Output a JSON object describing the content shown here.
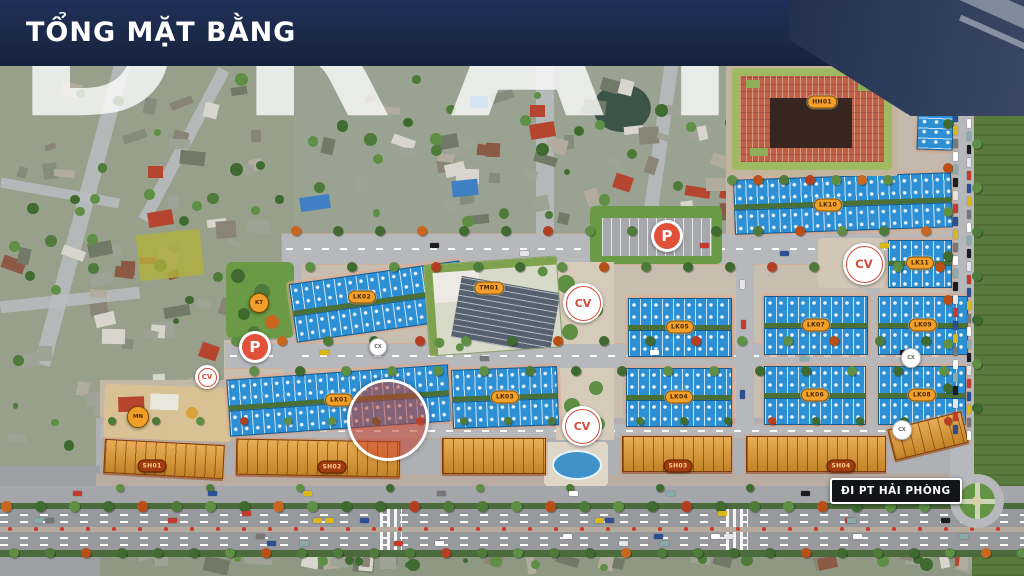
{
  "banner": {
    "title": "TỔNG MẶT BẰNG"
  },
  "watermark": {
    "text": "DRAFT"
  },
  "road_sign": {
    "text": "ĐI PT HẢI PHÒNG"
  },
  "palette": {
    "banner_bg": "#1b2846",
    "townhouse_roof": "#2d8fd4",
    "shophouse_roof": "#e59a2f",
    "label_bg": "#f1a02b",
    "marker_red": "#d14b38",
    "park_green": "#6a9a45",
    "road_grey": "#b6b8bb"
  },
  "blocks": [
    {
      "label": "LK01",
      "x": 228,
      "y": 372,
      "w": 222,
      "h": 56,
      "rot": -4
    },
    {
      "label": "LK02",
      "x": 292,
      "y": 272,
      "w": 172,
      "h": 58,
      "rot": -8,
      "lx": 362,
      "ly": 297
    },
    {
      "label": "LK03",
      "x": 452,
      "y": 368,
      "w": 106,
      "h": 58,
      "rot": -2
    },
    {
      "label": "LK04",
      "x": 626,
      "y": 368,
      "w": 106,
      "h": 58,
      "rot": 0
    },
    {
      "label": "LK05",
      "x": 628,
      "y": 298,
      "w": 104,
      "h": 58,
      "rot": 0
    },
    {
      "label": "LK06",
      "x": 764,
      "y": 366,
      "w": 102,
      "h": 58,
      "rot": 0
    },
    {
      "label": "LK07",
      "x": 764,
      "y": 296,
      "w": 104,
      "h": 58,
      "rot": 0
    },
    {
      "label": "LK08",
      "x": 878,
      "y": 366,
      "w": 88,
      "h": 58,
      "rot": 0
    },
    {
      "label": "LK09",
      "x": 878,
      "y": 296,
      "w": 90,
      "h": 58,
      "rot": 0
    },
    {
      "label": "LK10",
      "x": 734,
      "y": 176,
      "w": 218,
      "h": 54,
      "rot": -2,
      "lx": 828,
      "ly": 205
    },
    {
      "label": "LK11",
      "x": 888,
      "y": 240,
      "w": 64,
      "h": 46,
      "rot": 0
    },
    {
      "label": "LK12",
      "x": 918,
      "y": 66,
      "w": 36,
      "h": 84,
      "rot": 2,
      "vertical": true,
      "lx": 946,
      "ly": 95
    }
  ],
  "shop_rows": [
    {
      "label": "SH01",
      "x": 104,
      "y": 442,
      "w": 118,
      "h": 32,
      "rot": 3,
      "lx": 152,
      "ly": 466
    },
    {
      "label": "SH02",
      "x": 236,
      "y": 440,
      "w": 162,
      "h": 34,
      "rot": 1,
      "lx": 332,
      "ly": 467
    },
    {
      "label": "",
      "x": 442,
      "y": 438,
      "w": 102,
      "h": 34,
      "rot": 0
    },
    {
      "label": "SH03",
      "x": 622,
      "y": 436,
      "w": 108,
      "h": 34,
      "rot": 0,
      "lx": 678,
      "ly": 466
    },
    {
      "label": "SH04",
      "x": 746,
      "y": 436,
      "w": 138,
      "h": 34,
      "rot": 0,
      "lx": 841,
      "ly": 466
    },
    {
      "label": "",
      "x": 890,
      "y": 420,
      "w": 74,
      "h": 30,
      "rot": -14
    }
  ],
  "special": [
    {
      "label": "TM01",
      "type": "commercial-center",
      "x": 426,
      "y": 260,
      "w": 132,
      "h": 90,
      "rot": -4,
      "lx": 489,
      "ly": 288
    },
    {
      "label": "HH01",
      "type": "mixed-use-tower",
      "x": 726,
      "y": 62,
      "w": 172,
      "h": 114,
      "rot": 0,
      "lx": 822,
      "ly": 102
    }
  ],
  "markers": [
    {
      "text": "P",
      "type": "parking",
      "x": 255,
      "y": 347,
      "r": 16
    },
    {
      "text": "P",
      "type": "parking",
      "x": 667,
      "y": 236,
      "r": 16
    },
    {
      "text": "CV",
      "type": "park",
      "x": 207,
      "y": 377,
      "r": 12
    },
    {
      "text": "CV",
      "type": "park",
      "x": 583,
      "y": 303,
      "r": 20
    },
    {
      "text": "CV",
      "type": "park",
      "x": 582,
      "y": 426,
      "r": 20
    },
    {
      "text": "CV",
      "type": "park",
      "x": 864,
      "y": 264,
      "r": 21
    },
    {
      "text": "KT",
      "type": "technical",
      "x": 258,
      "y": 302,
      "r": 9
    },
    {
      "text": "MN",
      "type": "kindergarten",
      "x": 137,
      "y": 416,
      "r": 10
    },
    {
      "text": "CX",
      "type": "green",
      "x": 377,
      "y": 346,
      "r": 8
    },
    {
      "text": "CX",
      "type": "green",
      "x": 910,
      "y": 357,
      "r": 9
    },
    {
      "text": "CX",
      "type": "green",
      "x": 901,
      "y": 429,
      "r": 9
    }
  ],
  "highlight": {
    "x": 385,
    "y": 417,
    "r": 38
  },
  "roundabout": {
    "x": 977,
    "y": 501,
    "r": 27
  }
}
